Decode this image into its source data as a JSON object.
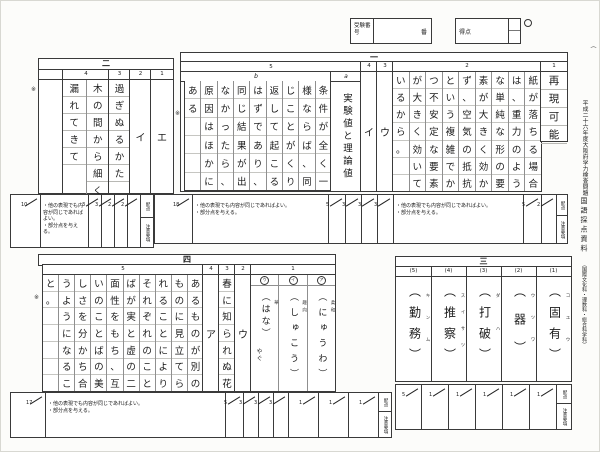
{
  "top_bar": {
    "exam_no_label": "受験番号",
    "ban_label": "番",
    "score_label": "得点",
    "circle_mark": "○",
    "paren_mark": "（"
  },
  "caption": {
    "line_main": "平成二十六年度大阪府学力検査問題",
    "line_title": "国語採点資料",
    "line_sub": "（国際文化科・理数科・総合科学科）"
  },
  "labels": {
    "haiten": "配点",
    "chui": "注意要項",
    "note_mark": "※"
  },
  "notes_common": [
    "・他の表現でも内容が同じであればよい。",
    "・部分点を与える。"
  ],
  "section1": {
    "label": "一",
    "col5": {
      "num": "5",
      "sub_a_label": "a",
      "sub_b_label": "b",
      "a_text": "実験値と理論値",
      "b_rows": 6,
      "b_cols": [
        "条件が全く一",
        "様ならば、同",
        "じことがくり",
        "返して起こる",
        "はずであり、",
        "同じ結果が出",
        "なかったら、",
        "原因はほかに",
        "ある"
      ]
    },
    "col4": {
      "num": "4",
      "answer": "イ"
    },
    "col3": {
      "num": "3",
      "answer": "ウ"
    },
    "col2": {
      "num": "2",
      "rows": 7,
      "cols": [
        "紙が落ちる場合",
        "は、重力のよう",
        "な単純な形の要",
        "素が大きく効か",
        "ず、空気の抵抗",
        "という複雑でか",
        "つ不安定な要素",
        "が大きく効いて",
        "いるから。"
      ]
    },
    "col1": {
      "num": "1",
      "answer": "再現可能"
    },
    "band": {
      "total": "18",
      "scores_left": [
        "5",
        "3",
        "3",
        "3"
      ],
      "scores_right": [
        "5",
        "2"
      ]
    }
  },
  "section2": {
    "label": "二",
    "col4": {
      "num": "4",
      "answer_right": "木の間から細く",
      "answer_left": "漏れてきて"
    },
    "col3": {
      "num": "3",
      "answer": "過ぎぬるかた"
    },
    "col2": {
      "num": "2",
      "answer": "イ"
    },
    "col1": {
      "num": "1",
      "answer": "エ"
    },
    "band": {
      "total": "10",
      "scores": [
        "3",
        "3",
        "2",
        "2"
      ]
    }
  },
  "section3": {
    "label": "三",
    "items": [
      {
        "num": "(1)",
        "answer": "（固有）",
        "kana": "コユウ"
      },
      {
        "num": "(2)",
        "answer": "（器）",
        "kana": "ウツワ"
      },
      {
        "num": "(3)",
        "answer": "（打破）",
        "kana": "ダハ"
      },
      {
        "num": "(4)",
        "answer": "（推察）",
        "kana": "スイサツ"
      },
      {
        "num": "(5)",
        "answer": "（勤務）",
        "kana": "キンム"
      }
    ],
    "band": {
      "total": "5",
      "scores": [
        "1",
        "1",
        "1",
        "1",
        "1"
      ]
    }
  },
  "section4": {
    "label": "四",
    "col5": {
      "num": "5",
      "rows": 7,
      "cols": [
        "あるものが別の",
        "ものに見立てら",
        "れることにより",
        "それぞれのこと",
        "ばが実と虚の二",
        "面性をもち、互",
        "いのことばの美",
        "しさを分かち合",
        "うようになるこ",
        "と。"
      ]
    },
    "col4": {
      "num": "4",
      "answer": "ア"
    },
    "col3": {
      "num": "3",
      "answer": "春に知られぬ花"
    },
    "col2": {
      "num": "2",
      "answer": "ウ"
    },
    "col1": {
      "num": "1",
      "items": [
        {
          "label": "ア",
          "reading": "（にゅうわ）",
          "source": "柔和",
          "suffix": ""
        },
        {
          "label": "イ",
          "reading": "（しゅこう）",
          "source": "趣向",
          "suffix": ""
        },
        {
          "label": "ウ",
          "reading": "（はな）",
          "source": "華",
          "suffix": "やぐ"
        }
      ]
    },
    "band": {
      "total": "17",
      "scores_left": [
        "5",
        "3",
        "3",
        "3"
      ],
      "scores_right": [
        "1",
        "1",
        "1"
      ]
    }
  }
}
